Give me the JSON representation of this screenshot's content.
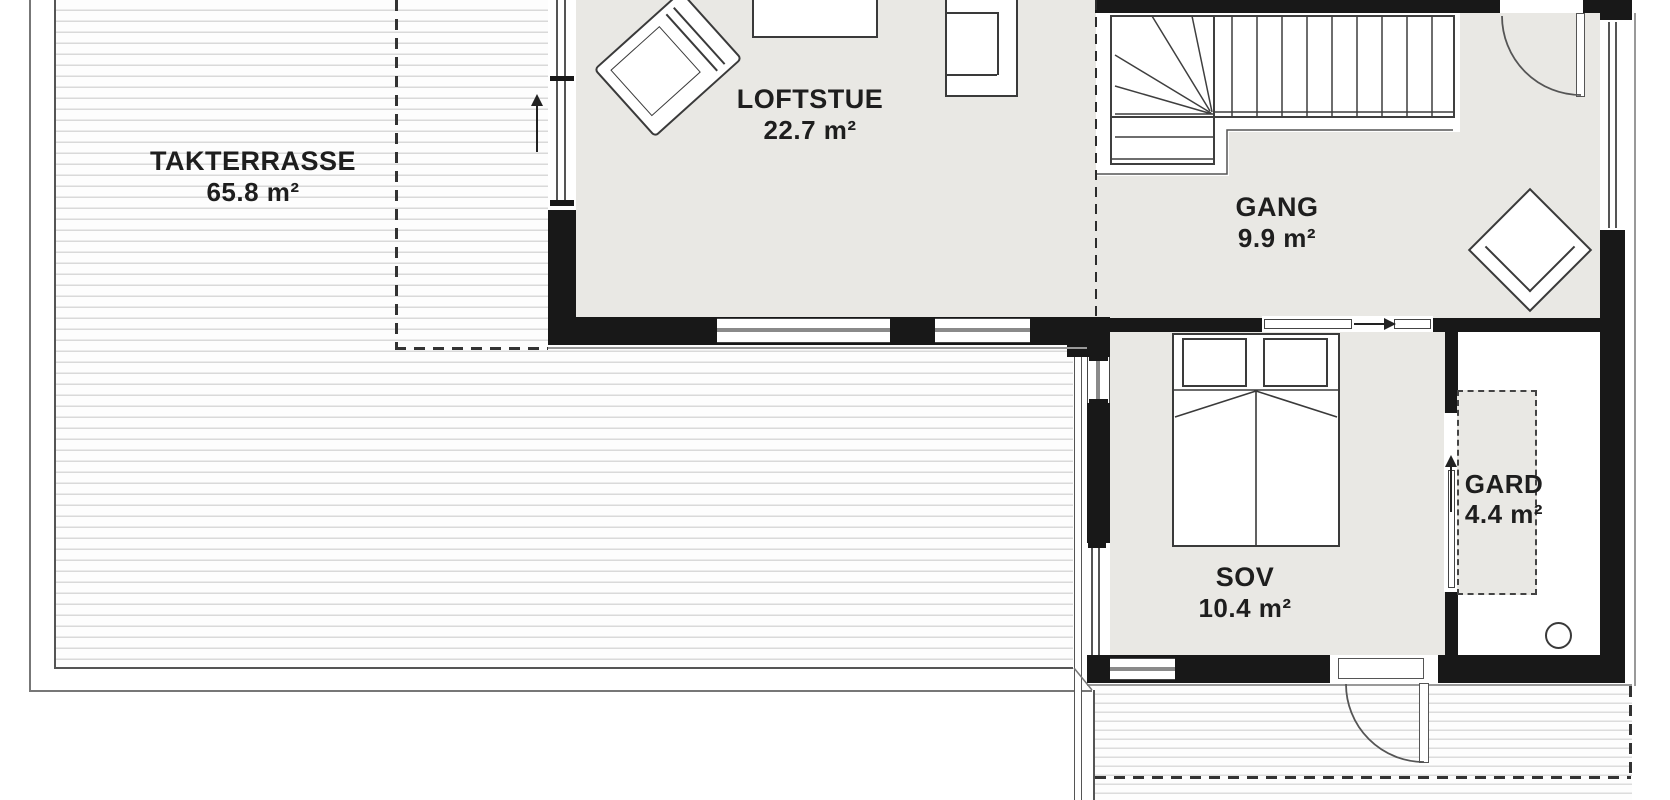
{
  "plan": {
    "title": "Loft floor plan",
    "rooms": [
      {
        "id": "takterrasse",
        "name": "TAKTERRASSE",
        "area": "65.8 m²"
      },
      {
        "id": "loftstue",
        "name": "LOFTSTUE",
        "area": "22.7 m²"
      },
      {
        "id": "gang",
        "name": "GANG",
        "area": "9.9 m²"
      },
      {
        "id": "sov",
        "name": "SOV",
        "area": "10.4 m²"
      },
      {
        "id": "gard",
        "name": "GARD",
        "area": "4.4 m²"
      }
    ],
    "features": [
      "winder-staircase",
      "entry-door",
      "terrace-door",
      "sliding-door-gang-sov",
      "sliding-door-sov-gard",
      "wardrobe-dashed",
      "double-bed",
      "armchairs",
      "coffee-table",
      "balcony"
    ],
    "colors": {
      "wall": "#181818",
      "floor": "#e9e8e4",
      "deck_line": "#d9d9d9",
      "outline": "#555555"
    }
  }
}
